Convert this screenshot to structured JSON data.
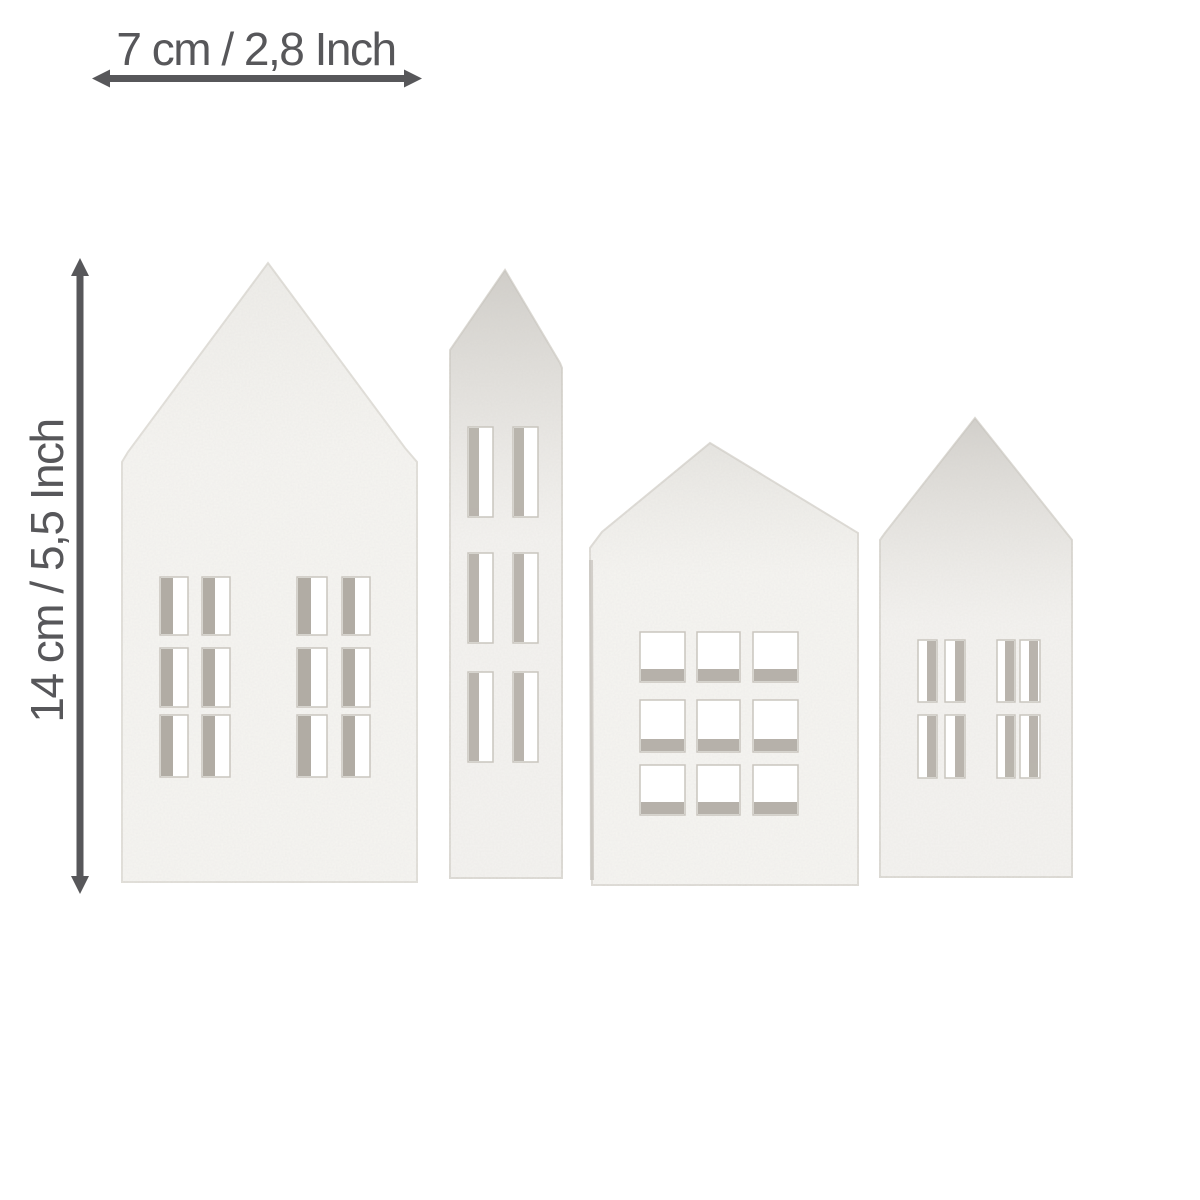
{
  "canvas": {
    "background": "#ffffff",
    "annotation_color": "#57575a"
  },
  "dimensions": {
    "width_label": "7 cm / 2,8 Inch",
    "height_label": "14 cm / 5,5 Inch"
  },
  "figure": {
    "subject": "four white textured decorative houses with cut-out windows",
    "house_color": "#f6f5f2",
    "window_shadow_color": "#a49e95",
    "houses": [
      {
        "name": "large-gable-house",
        "windows": "two windows of 2x3 rectangular panes"
      },
      {
        "name": "tall-tower-house",
        "windows": "one column window of 2x3 tall panes"
      },
      {
        "name": "wide-gable-house",
        "windows": "one window of 3x3 square panes"
      },
      {
        "name": "small-gable-house",
        "windows": "two windows of 2x2 tall panes"
      }
    ]
  }
}
